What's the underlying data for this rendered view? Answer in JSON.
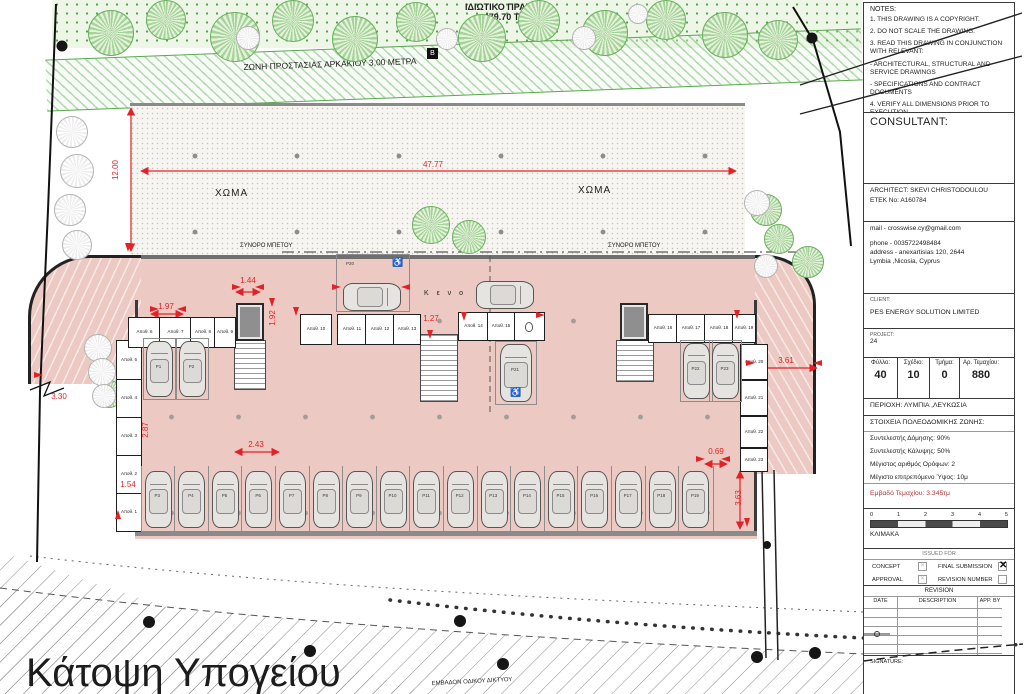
{
  "drawing": {
    "private_green_label": "ΙΔΙΩΤΙΚΟ ΠΡΑΣΙΝΟ",
    "private_green_area": "479.70 Τ.Μ",
    "protection_zone_label": "ΖΩΝΗ ΠΡΟΣΤΑΣΙΑΣ ΑΡΚΑΚΙΟΥ 3,00 ΜΕΤΡΑ",
    "soil_left": "ΧΩΜΑ",
    "soil_right": "ΧΩΜΑ",
    "marker_b": "B",
    "boundary_concrete_left": "ΣΥΝΟΡΟ ΜΠΕΤΟΥ",
    "boundary_concrete_right": "ΣΥΝΟΡΟ ΜΠΕΤΟΥ",
    "void_label": "Κ ε ν ο",
    "road_area_label": "ΕΜΒΑΔΟΝ ΟΔΙΚΟΥ ΔΙΚΤΥΟΥ",
    "sheet_title": "Κάτοψη Υπογείου",
    "dimensions": {
      "site_width": "47.77",
      "site_depth": "12.00",
      "elev_front": "1.44",
      "store_front": "1.97",
      "elev_side": "1.92",
      "stair_width": "1.27",
      "left_depth": "2.87",
      "stall_width": "2.43",
      "road_offset": "3.30",
      "small_left": "1.54",
      "ramp_width": "3.61",
      "corridor": "0.69",
      "ramp_depth": "3.63"
    },
    "storage_labels": [
      "Αποθ. 1",
      "Αποθ. 2",
      "Αποθ. 3",
      "Αποθ. 4",
      "Αποθ. 5",
      "Αποθ. 6",
      "Αποθ. 7",
      "Αποθ. 8",
      "Αποθ. 9",
      "Αποθ. 10",
      "Αποθ. 11",
      "Αποθ. 12",
      "Αποθ. 13",
      "Αποθ. 14",
      "Αποθ. 15",
      "Αποθ. 16",
      "Αποθ. 17",
      "Αποθ. 18",
      "Αποθ. 19",
      "Αποθ. 20",
      "Αποθ. 21",
      "Αποθ. 22",
      "Αποθ. 23"
    ],
    "parking_labels": {
      "upper_left": [
        "P1",
        "P2"
      ],
      "bottom_row": [
        "P3",
        "P4",
        "P5",
        "P6",
        "P7",
        "P8",
        "P9",
        "P10",
        "P11",
        "P12",
        "P13",
        "P14",
        "P15",
        "P16",
        "P17",
        "P18",
        "P19"
      ],
      "disabled": [
        "P20",
        "P21"
      ],
      "right": [
        "P22",
        "P23"
      ]
    }
  },
  "title_block": {
    "notes": {
      "heading": "NOTES:",
      "items": [
        "1. THIS DRAWING IS A COPYRIGHT.",
        "2. DO NOT SCALE THE DRAWING.",
        "3. READ THIS DRAWING IN CONJUNCTION WITH RELEVANT:",
        "-    ARCHITECTURAL, STRUCTURAL AND SERVICE DRAWINGS",
        "-    SPECIFICATIONS AND CONTRACT DOCUMENTS",
        "4. VERIFY ALL DIMENSIONS PRIOR TO EXECUTION."
      ]
    },
    "consultant_label": "CONSULTANT:",
    "architect_line1": "ARCHITECT:  SKEVI CHRISTODOULOU",
    "architect_line2": "ETEK No:   A160784",
    "contact": {
      "mail": "mail - crosswise.cy@gmail.com",
      "phone": "phone - 0035722498484",
      "address1": "address - anexartisias 120, 2644",
      "address2": "Lymbia ,Nicosia, Cyprus"
    },
    "client_label": "CLIENT:",
    "client_name": "PES ENERGY SOLUTION LIMITED",
    "project_label": "PROJECT:",
    "project_number": "24",
    "sheet_table": {
      "headers": [
        "Φύλλο:",
        "Σχέδιο:",
        "Τμήμα:",
        "Αρ. Τεμαχίου:"
      ],
      "values": [
        "40",
        "10",
        "0",
        "880"
      ]
    },
    "region": "ΠΕΡΙΟΧΗ: ΛΥΜΠΙΑ ,ΛΕΥΚΩΣΙΑ",
    "zoning_heading": "ΣΤΟΙΧΕΙΑ ΠΟΛΕΟΔΟΜΙΚΗΣ ΖΩΝΗΣ:",
    "zoning_items": [
      "Συντελεστής Δόμησης: 90%",
      "Συντελεστής Κάλυψης: 50%",
      "Μέγιστος αριθμός Ορόφων: 2",
      "Μέγιστο επιτρεπόμενο Ύψος: 10μ"
    ],
    "plot_area": "Εμβαδό Τεμαχίου: 3.345τμ",
    "scale": {
      "ticks": [
        "0",
        "1",
        "2",
        "3",
        "4",
        "5"
      ],
      "label": "ΚΛΙΜΑΚΑ"
    },
    "issued_for": {
      "heading": "ISSUED FOR",
      "rows": [
        {
          "left": "CONCEPT",
          "left_state": "dim",
          "right": "FINAL SUBMISSION",
          "right_state": "checked"
        },
        {
          "left": "APPROVAL",
          "left_state": "dim",
          "right": "REVISION NUMBER",
          "right_state": "empty"
        }
      ]
    },
    "revision": {
      "heading": "REVISION",
      "columns": [
        "DATE",
        "DESCRIPTION",
        "APP. BY"
      ],
      "empty_rows": 6
    },
    "signature_label": "SIGNATURE:"
  },
  "colors": {
    "building_pink": "#ecc9c2",
    "dim_red": "#e32227",
    "plot_area_red": "#b33434",
    "zone_green": "#58a84f"
  }
}
